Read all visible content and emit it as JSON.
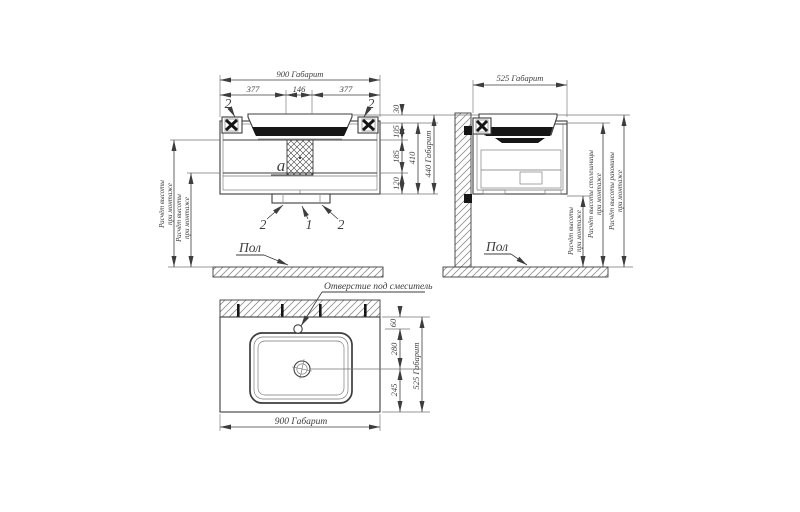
{
  "colors": {
    "line": "#3d3d3d",
    "thin": "#757575",
    "dark": "#161616",
    "hatch": "#8f8f8f",
    "bg": "#ffffff"
  },
  "labels": {
    "front": {
      "overall_w": "900 Габарит",
      "seg_a": "377",
      "seg_b": "146",
      "seg_c": "377",
      "h30": "30",
      "h105": "105",
      "h185": "185",
      "h120": "120",
      "h410": "410",
      "overall_h": "440 Габарит",
      "part2": "2",
      "part1": "1",
      "panel": "a",
      "floor": "Пол",
      "mount_l1": "Расчёт высоты",
      "mount_l2": "при монтаже"
    },
    "side": {
      "overall_d": "525 Габарит",
      "floor": "Пол",
      "mount_l1": "Расчёт высоты",
      "mount_l2": "при монтаже",
      "counter_l1": "Расчёт высоты столешницы",
      "counter_l2": "при монтаже",
      "basin_l1": "Расчёт высоты раковины",
      "basin_l2": "при монтаже"
    },
    "plan": {
      "faucet_note": "Отверстие под смеситель",
      "d60": "60",
      "d280": "280",
      "d245": "245",
      "overall_d": "525 Габарит",
      "overall_w": "900 Габарит"
    }
  }
}
